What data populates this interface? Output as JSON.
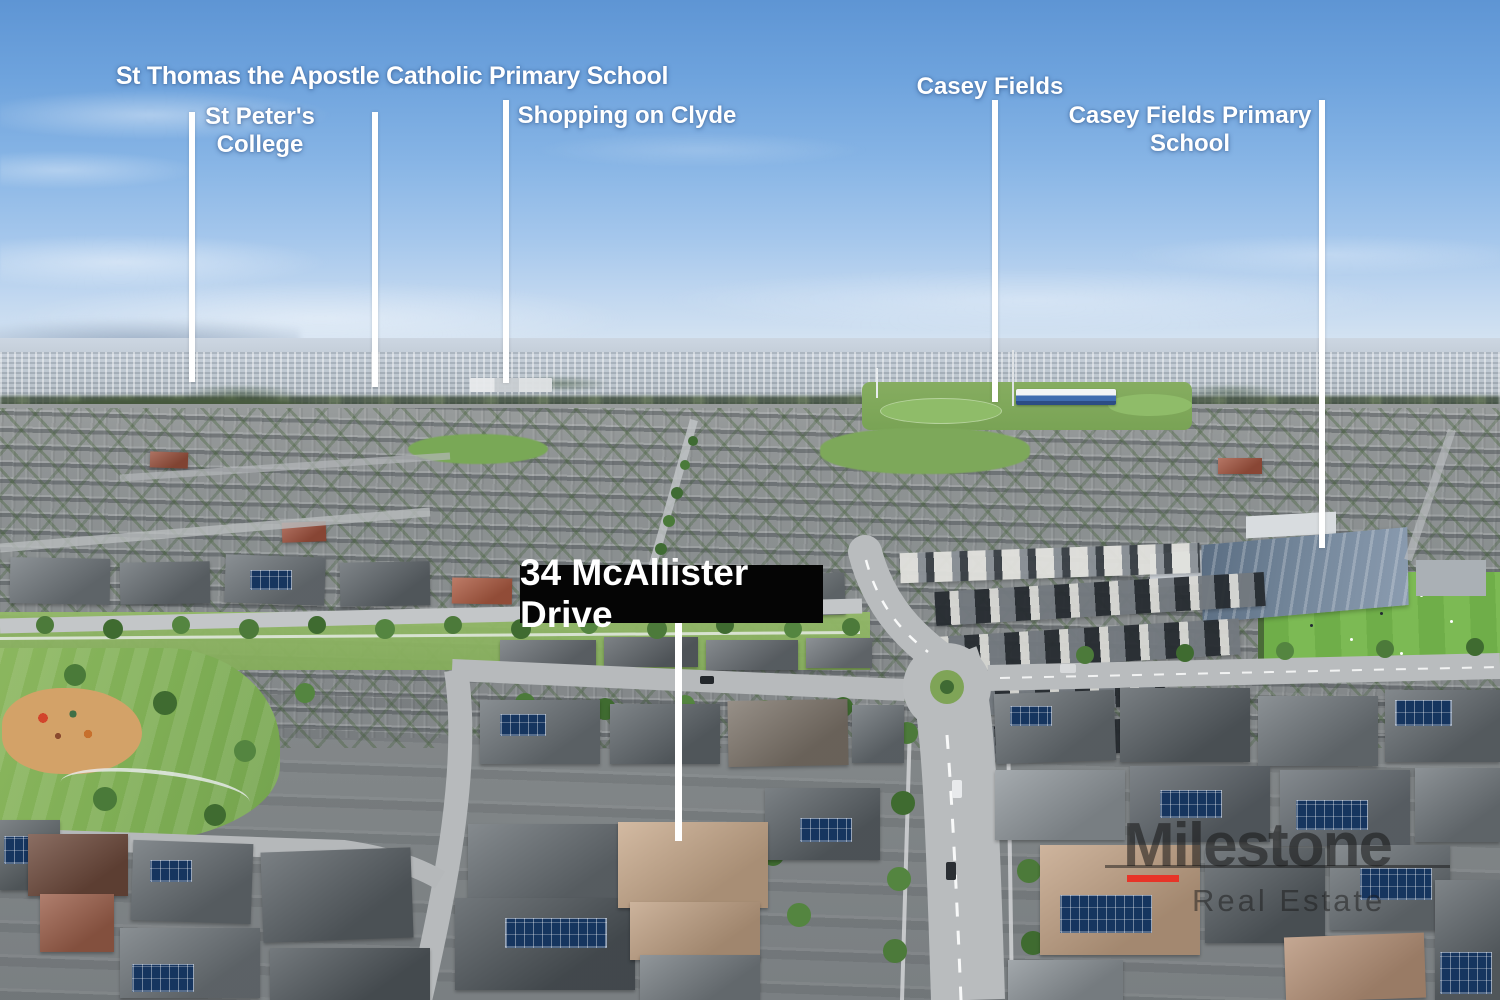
{
  "callouts": [
    {
      "id": "st-thomas-school",
      "label": "St Thomas the Apostle Catholic Primary School"
    },
    {
      "id": "st-peters-college",
      "label": "St Peter's College",
      "line1": "St Peter's",
      "line2": "College"
    },
    {
      "id": "shopping-on-clyde",
      "label": "Shopping on Clyde"
    },
    {
      "id": "casey-fields",
      "label": "Casey Fields"
    },
    {
      "id": "casey-fields-primary-school",
      "label": "Casey Fields Primary School",
      "line1": "Casey Fields Primary",
      "line2": "School"
    }
  ],
  "property_marker": {
    "address": "34 McAllister Drive"
  },
  "watermark": {
    "brand": "Milestone",
    "tagline": "Real Estate",
    "accent_color": "#e73428"
  },
  "colors": {
    "callout_line": "#ffffff",
    "callout_text": "#ffffff",
    "address_box_bg": "#000000",
    "address_text": "#ffffff",
    "sky_top": "#5e95d4",
    "sky_horizon": "#d8e5f2"
  }
}
